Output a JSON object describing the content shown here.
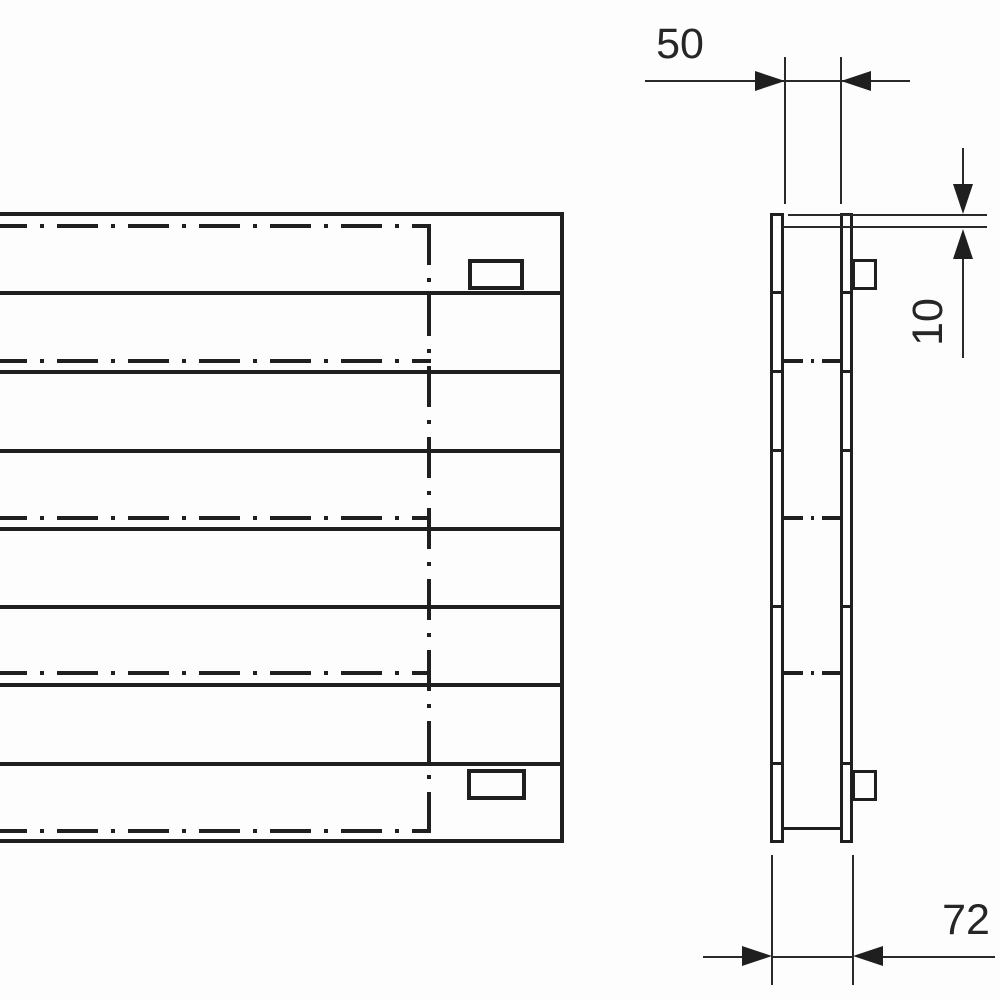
{
  "drawing": {
    "kind": "technical-drawing",
    "subject": "horizontal panel radiator, front view and side profile view",
    "colors": {
      "line": "#1f1f1f",
      "background": "#fdfdfd"
    },
    "front_view": {
      "panel_bands": 8,
      "center_lines": 5,
      "brackets": 2,
      "hidden_boundary": "dash-dot rectangle on right portion"
    },
    "side_view": {
      "profile_bars": 2,
      "brackets": 2,
      "center_line_crossings": 3
    },
    "dimensions": {
      "gap": {
        "value": "50",
        "orientation": "horizontal",
        "location": "top, between profile bars"
      },
      "offset": {
        "value": "10",
        "orientation": "vertical",
        "location": "upper right, top edge offset"
      },
      "depth": {
        "value": "72",
        "orientation": "horizontal",
        "location": "bottom, overall depth"
      }
    }
  }
}
